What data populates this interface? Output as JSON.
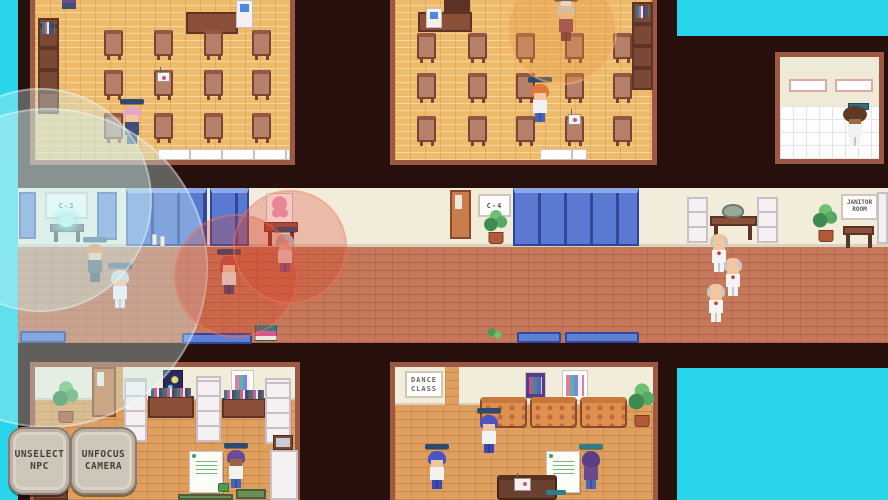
{
  "signs": {
    "classroom_left": "C-3",
    "classroom_right": "C-4",
    "janitor_line1": "JANITOR",
    "janitor_line2": "ROOM",
    "dance_line1": "DANCE",
    "dance_line2": "CLASS"
  },
  "ui": {
    "unselect_line1": "UNSELECT",
    "unselect_line2": "NPC",
    "unfocus_line1": "UNFOCUS",
    "unfocus_line2": "CAMERA"
  },
  "colors": {
    "outside_cyan": "#28d5ea",
    "background_wall": "#27100b",
    "hall_wall": "#f2ecdb",
    "hall_floor": "#c6795a",
    "classroom_floor": "#eeba6c",
    "locker_blue": "#5a7ad2",
    "npc_name_bar_blue": "#2b4a74",
    "npc_name_bar_teal": "#2e7d8a",
    "focus_circle_cyan": "rgba(205,244,244,0.35)",
    "focus_circle_red": "rgba(214,62,38,0.28)",
    "focus_circle_orange": "rgba(228,150,66,0.34)"
  }
}
